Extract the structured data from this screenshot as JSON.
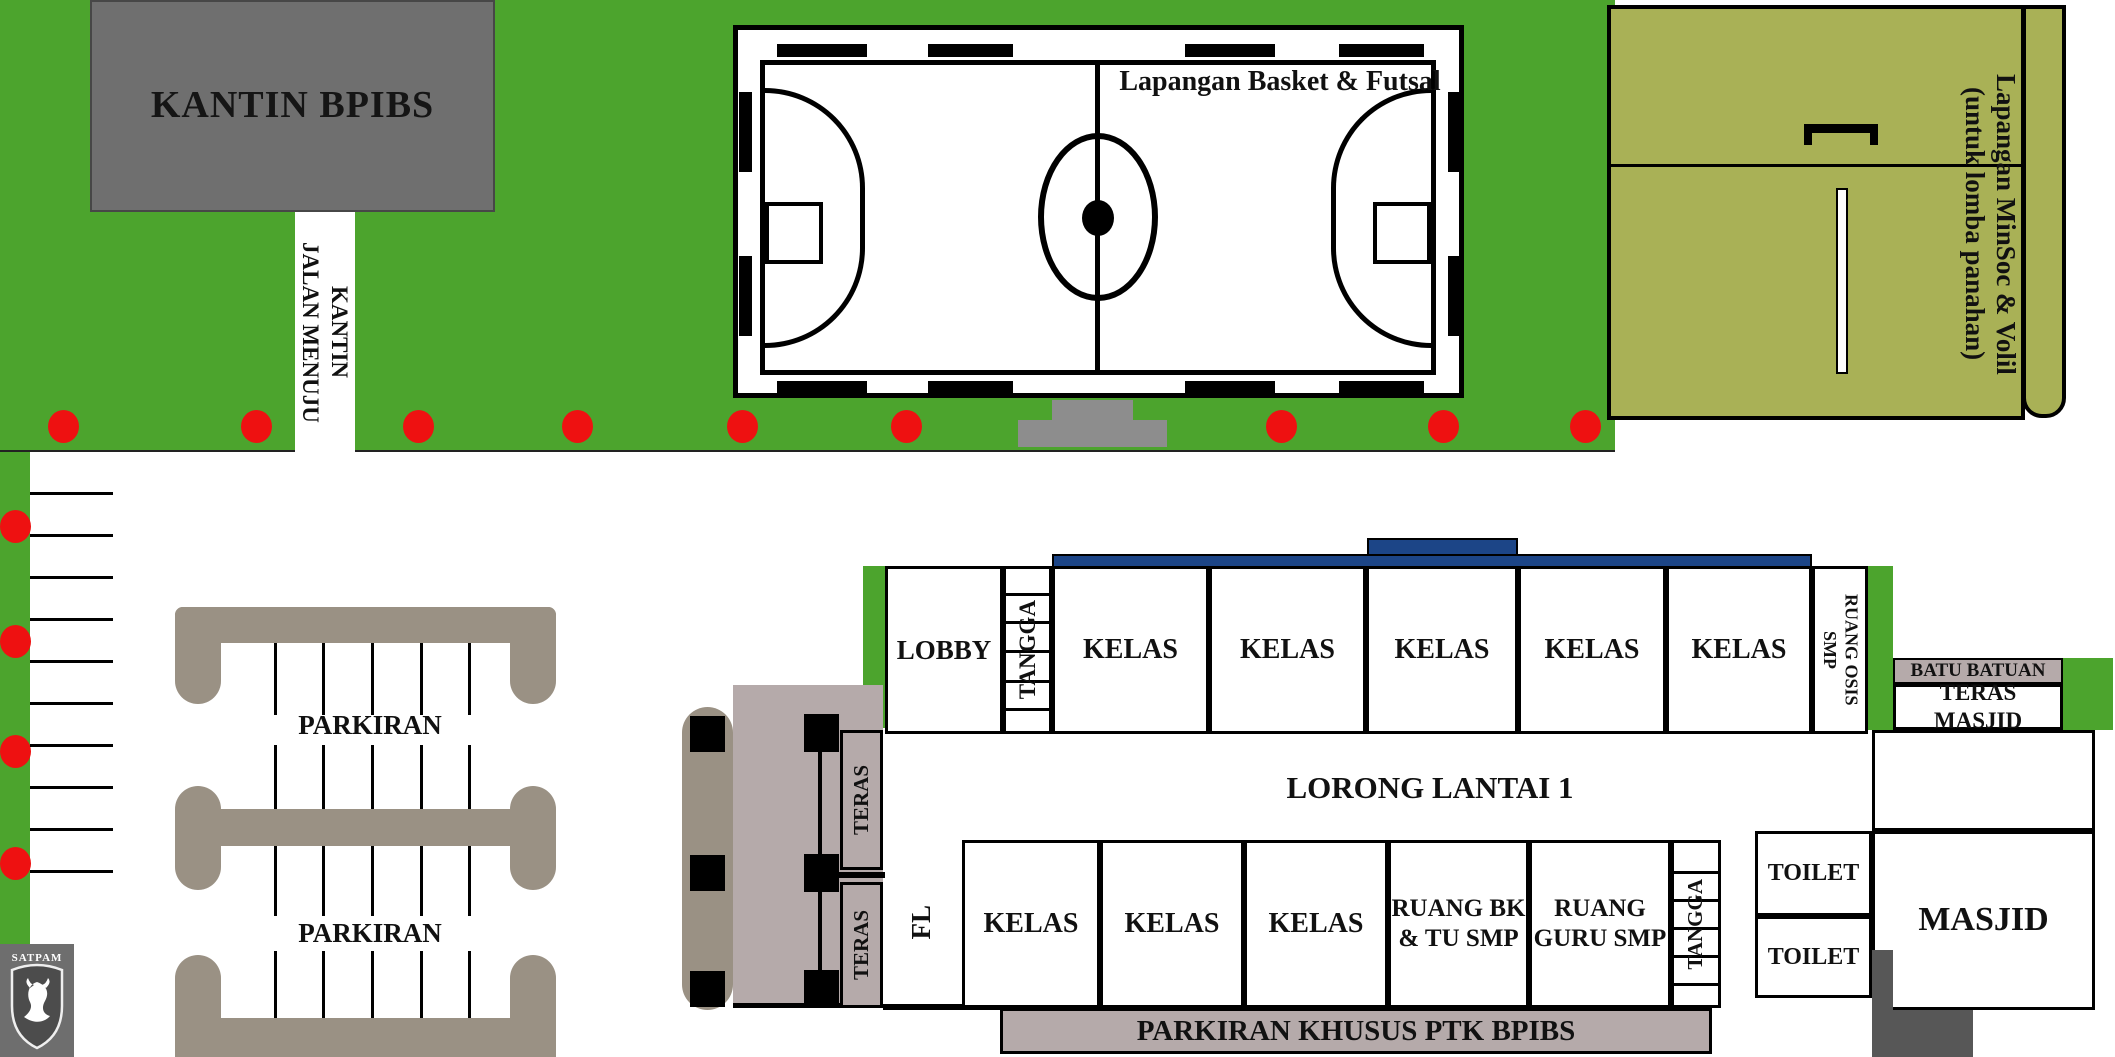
{
  "title": "Denah kampus BPIBS (site plan)",
  "colors": {
    "field_green": "#4CA42D",
    "olive": "#A9B156",
    "taupe": "#9A9184",
    "mauve": "#B5AAAA",
    "blue_bar": "#1C4587",
    "red_dot": "#EE1111",
    "kantin_gray": "#6F6F6F",
    "satpam_gray": "#6E6E6E",
    "podium_gray": "#8D8D8D",
    "dark_gray": "#575757"
  },
  "kantin": {
    "label": "KANTIN BPIBS"
  },
  "road": {
    "line1": "JALAN MENUJU",
    "line2": "KANTIN"
  },
  "court": {
    "title": "Lapangan Basket & Futsal"
  },
  "archery": {
    "line1": "Lapangan MinSoc & Volil",
    "line2": "(untuk lomba panahan)"
  },
  "upper": {
    "lobby": "LOBBY",
    "tangga": "TANGGA",
    "classrooms": [
      "KELAS",
      "KELAS",
      "KELAS",
      "KELAS",
      "KELAS"
    ],
    "osis1": "RUANG OSIS",
    "osis2": "SMP"
  },
  "corridor": {
    "label": "LORONG LANTAI 1"
  },
  "teras": {
    "label1": "TERAS",
    "label2": "TERAS",
    "fl": "FL"
  },
  "lower": {
    "classrooms": [
      "KELAS",
      "KELAS",
      "KELAS"
    ],
    "bk1": "RUANG BK",
    "bk2": "& TU SMP",
    "guru1": "RUANG",
    "guru2": "GURU SMP",
    "tangga": "TANGGA"
  },
  "mosque": {
    "batu": "BATU BATUAN",
    "teras": "TERAS MASJID",
    "toilet1": "TOILET",
    "toilet2": "TOILET",
    "masjid": "MASJID"
  },
  "parking": {
    "label1": "PARKIRAN",
    "label2": "PARKIRAN",
    "khusus": "PARKIRAN KHUSUS PTK BPIBS"
  },
  "satpam": {
    "label": "SATPAM"
  }
}
